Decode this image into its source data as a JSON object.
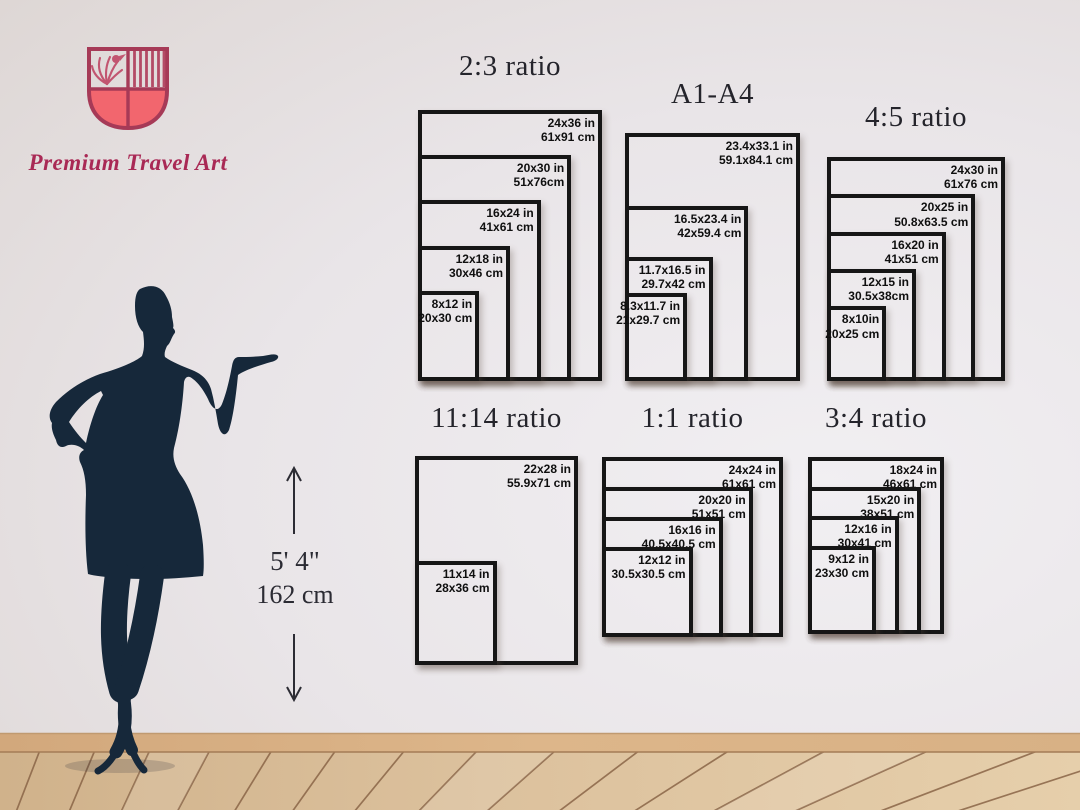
{
  "brand": {
    "name": "Premium Travel Art",
    "colors": {
      "shield_outline": "#a63a57",
      "shield_fill": "#f2666e",
      "shield_motif": "#c25570",
      "brand_text": "#a92955"
    }
  },
  "height_marker": {
    "imperial": "5' 4\"",
    "metric": "162 cm"
  },
  "frame_style": {
    "border_color": "#161616",
    "label_color": "#0f0f0f"
  },
  "charts": [
    {
      "title": "2:3 ratio",
      "frames": [
        {
          "in": "24x36 in",
          "cm": "61x91 cm",
          "scale": 1
        },
        {
          "in": "20x30 in",
          "cm": "51x76cm",
          "scale": 0.833
        },
        {
          "in": "16x24 in",
          "cm": "41x61 cm",
          "scale": 0.667
        },
        {
          "in": "12x18 in",
          "cm": "30x46 cm",
          "scale": 0.5
        },
        {
          "in": "8x12 in",
          "cm": "20x30 cm",
          "scale": 0.333
        }
      ]
    },
    {
      "title": "A1-A4",
      "frames": [
        {
          "in": "23.4x33.1 in",
          "cm": "59.1x84.1 cm",
          "scale": 1
        },
        {
          "in": "16.5x23.4 in",
          "cm": "42x59.4 cm",
          "scale": 0.705
        },
        {
          "in": "11.7x16.5 in",
          "cm": "29.7x42 cm",
          "scale": 0.5
        },
        {
          "in": "8.3x11.7 in",
          "cm": "21x29.7 cm",
          "scale": 0.355
        }
      ]
    },
    {
      "title": "4:5 ratio",
      "frames": [
        {
          "in": "24x30 in",
          "cm": "61x76 cm",
          "scale": 1
        },
        {
          "in": "20x25 in",
          "cm": "50.8x63.5 cm",
          "scale": 0.833
        },
        {
          "in": "16x20 in",
          "cm": "41x51 cm",
          "scale": 0.667
        },
        {
          "in": "12x15 in",
          "cm": "30.5x38cm",
          "scale": 0.5
        },
        {
          "in": "8x10in",
          "cm": "20x25 cm",
          "scale": 0.333
        }
      ]
    },
    {
      "title": "11:14 ratio",
      "frames": [
        {
          "in": "22x28 in",
          "cm": "55.9x71 cm",
          "scale": 1
        },
        {
          "in": "11x14 in",
          "cm": "28x36 cm",
          "scale": 0.5
        }
      ]
    },
    {
      "title": "1:1 ratio",
      "frames": [
        {
          "in": "24x24 in",
          "cm": "61x61 cm",
          "scale": 1
        },
        {
          "in": "20x20 in",
          "cm": "51x51 cm",
          "scale": 0.833
        },
        {
          "in": "16x16 in",
          "cm": "40.5x40.5 cm",
          "scale": 0.667
        },
        {
          "in": "12x12 in",
          "cm": "30.5x30.5 cm",
          "scale": 0.5
        }
      ]
    },
    {
      "title": "3:4 ratio",
      "frames": [
        {
          "in": "18x24 in",
          "cm": "46x61 cm",
          "scale": 1
        },
        {
          "in": "15x20 in",
          "cm": "38x51 cm",
          "scale": 0.833
        },
        {
          "in": "12x16 in",
          "cm": "30x41 cm",
          "scale": 0.667
        },
        {
          "in": "9x12 in",
          "cm": "23x30 cm",
          "scale": 0.5
        }
      ]
    }
  ]
}
